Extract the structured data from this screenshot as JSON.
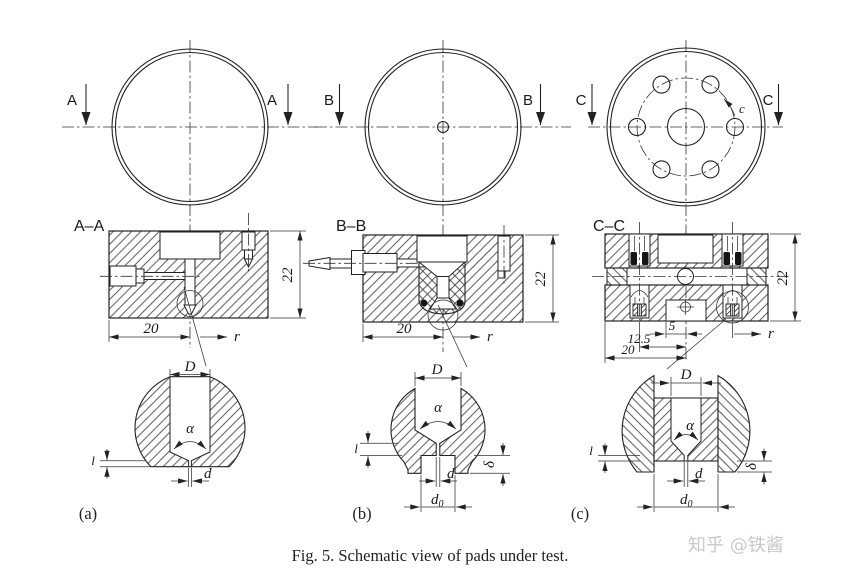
{
  "figure": {
    "caption": "Fig. 5. Schematic view of pads under test.",
    "watermark": "知乎 @铁酱"
  },
  "top_views": [
    {
      "id": "a",
      "marker_left": "A",
      "marker_right": "A"
    },
    {
      "id": "b",
      "marker_left": "B",
      "marker_right": "B"
    },
    {
      "id": "c",
      "marker_left": "C",
      "marker_right": "C",
      "rotation_label": "c"
    }
  ],
  "sections": [
    {
      "id": "a",
      "title": "A–A",
      "height_dim": "22",
      "width_dim": "20",
      "radial_label": "r"
    },
    {
      "id": "b",
      "title": "B–B",
      "height_dim": "22",
      "width_dim": "20",
      "radial_label": "r"
    },
    {
      "id": "c",
      "title": "C–C",
      "height_dim": "22",
      "width_dim": "20",
      "offset_dim_small": "5",
      "offset_dim_mid": "12.5",
      "radial_label": "r"
    }
  ],
  "details": [
    {
      "id": "a",
      "label": "(a)",
      "bore_dim": "D",
      "angle_dim": "α",
      "land_dim": "l",
      "hole_dim": "d"
    },
    {
      "id": "b",
      "label": "(b)",
      "bore_dim": "D",
      "angle_dim": "α",
      "land_dim": "l",
      "hole_dim": "d",
      "recess_dim": "d",
      "recess_sub": "0",
      "depth_dim": "δ"
    },
    {
      "id": "c",
      "label": "(c)",
      "bore_dim": "D",
      "angle_dim": "α",
      "land_dim": "l",
      "hole_dim": "d",
      "recess_dim": "d",
      "recess_sub": "0",
      "depth_dim": "δ"
    }
  ]
}
